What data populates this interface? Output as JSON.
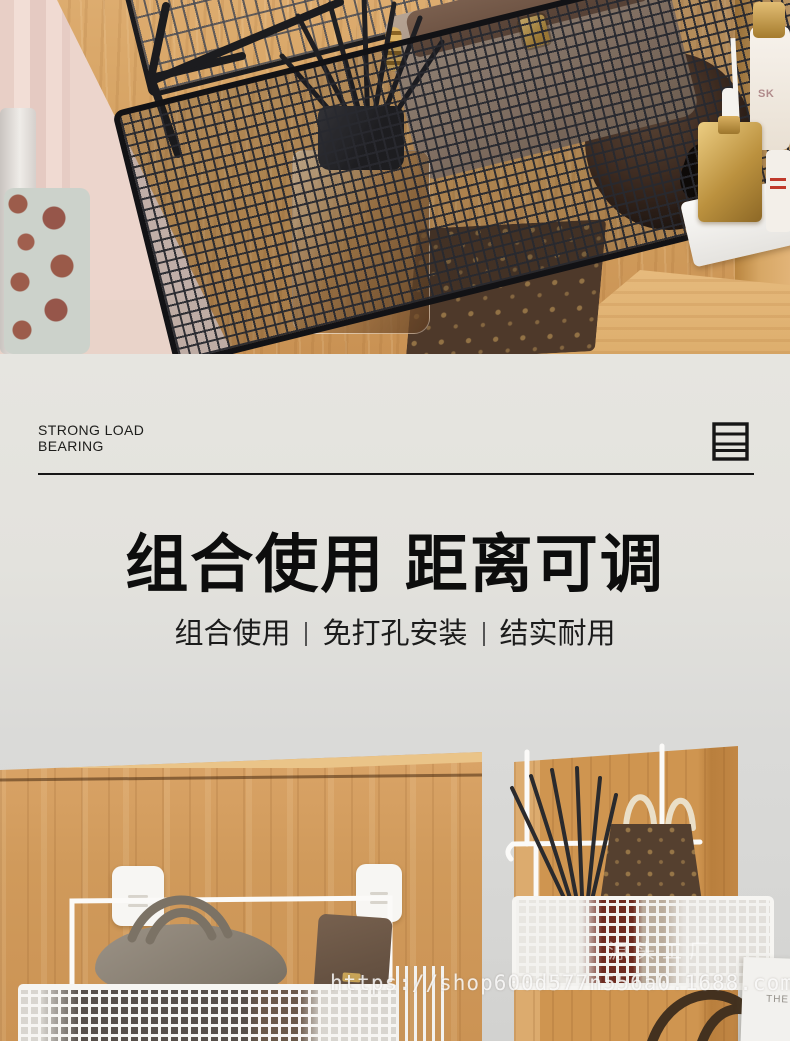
{
  "banner": {
    "eyebrow": "STRONG LOAD BEARING",
    "heading": "组合使用 距离可调",
    "subtitle_items": [
      "组合使用",
      "免打孔安装",
      "结实耐用"
    ],
    "icon": "shelf-rack-icon",
    "bg_color": "#e3e2dd",
    "text_color": "#0d0d0d"
  },
  "top_photo": {
    "cosmetic_label": "SK",
    "palette": {
      "wood": "#d29e5d",
      "basket_black": "#1a1a1d",
      "curtain_pink": "#ecd5cc",
      "bag_taupe": "#a18c7d",
      "monogram_brown": "#4e392a",
      "gold": "#c59a4a"
    }
  },
  "bottom_photo": {
    "card_label": "THE",
    "watermark_url": "https://shop600d577n556a0.1688.com",
    "watermark_factory": "源头工厂",
    "palette": {
      "wall_gray": "#d9d9d7",
      "wood": "#d09a5b",
      "basket_white": "#f6f5f2",
      "bag_gray": "#8d8478",
      "monogram_brown": "#55402f"
    }
  }
}
